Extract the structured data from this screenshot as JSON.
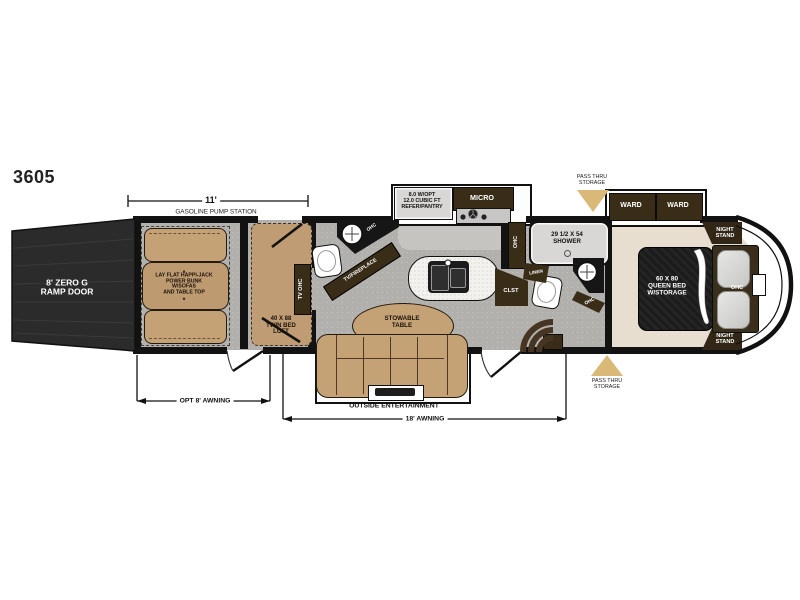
{
  "model": "3605",
  "dims": {
    "garage_length": "11'",
    "gas_station": "GASOLINE PUMP STATION",
    "opt_awning": "OPT 8' AWNING",
    "main_awning": "18' AWNING"
  },
  "ramp": {
    "lines": [
      "8' ZERO G",
      "RAMP DOOR"
    ]
  },
  "garage": {
    "bunk_lines": [
      "LAY FLAT HAPPI-JACK",
      "POWER BUNK",
      "W/SOFAS",
      "AND TABLE TOP"
    ],
    "arrow_up": "▲",
    "arrow_down": "▼"
  },
  "loft": {
    "lines": [
      "40 X 88",
      "TWIN BED",
      "LOFT"
    ],
    "tv_ohc": "TV OHC"
  },
  "half_bath": {
    "ohc": "OHC"
  },
  "living": {
    "tv_fireplace": "TV/FIREPLACE",
    "table_lines": [
      "STOWABLE",
      "TABLE"
    ],
    "outside_entertainment": "OUTSIDE ENTERTAINMENT"
  },
  "kitchen": {
    "refer_lines": [
      "8.0 W/OPT",
      "12.0 CUBIC FT",
      "REFER/PANTRY"
    ],
    "micro": "MICRO",
    "ohc": "OHC"
  },
  "bath": {
    "shower_lines": [
      "29 1/2 X 54",
      "SHOWER"
    ],
    "linen": "LINEN",
    "clst": "CLST",
    "ohc": "OHC"
  },
  "bedroom": {
    "bed_lines": [
      "60 X 80",
      "QUEEN BED",
      "W/STORAGE"
    ],
    "ward": "WARD",
    "night_stand_lines": [
      "NIGHT",
      "STAND"
    ],
    "ohc": "OHC"
  },
  "pass_thru_lines": [
    "PASS THRU",
    "STORAGE"
  ],
  "colors": {
    "tan_furniture": "#c5a176",
    "dark_wood": "#3a2d18",
    "floor_gray": "#b2b0ad",
    "bedroom_floor": "#e8decf",
    "pass_thru_arrow": "#d9b878",
    "bed_black": "#1f1f1f"
  }
}
